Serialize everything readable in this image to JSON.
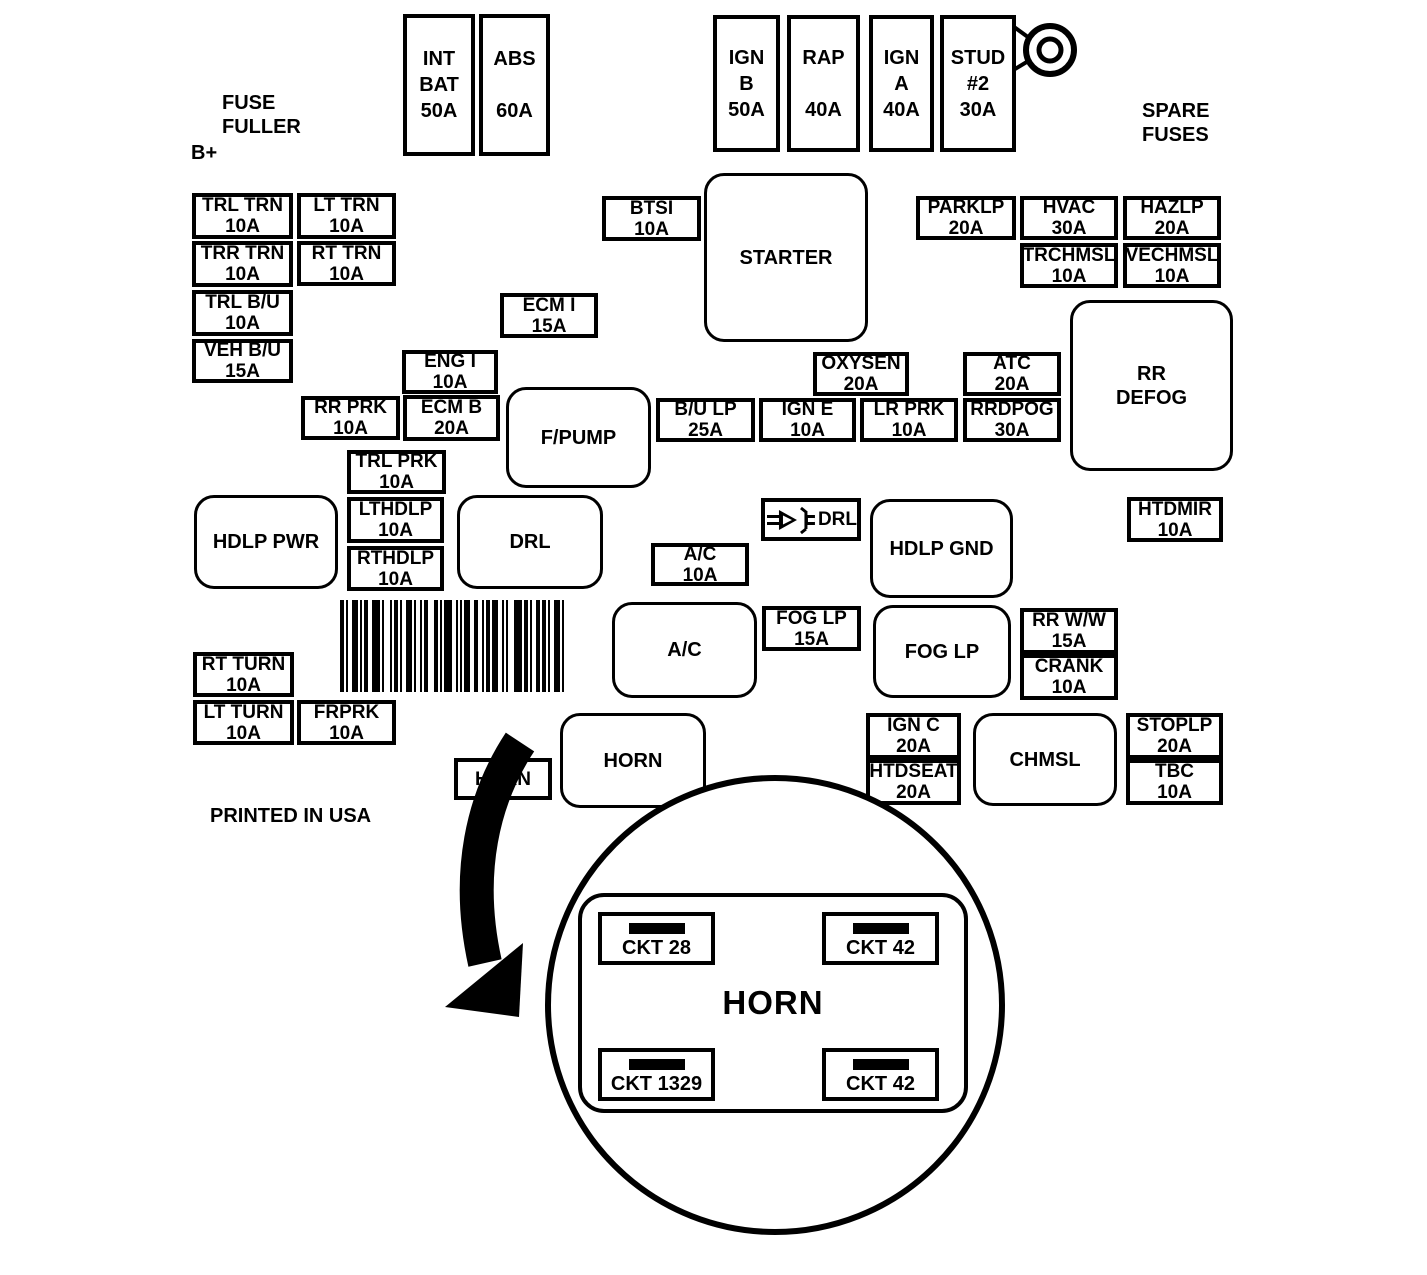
{
  "labels": [
    {
      "name": "fuse-puller-label",
      "lines": [
        "FUSE",
        "FULLER"
      ],
      "x": 222,
      "y": 91
    },
    {
      "name": "b-plus-label",
      "lines": [
        "B+"
      ],
      "x": 191,
      "y": 141
    },
    {
      "name": "spare-fuses-label",
      "lines": [
        "SPARE",
        "FUSES"
      ],
      "x": 1142,
      "y": 99
    },
    {
      "name": "printed-in-usa-label",
      "lines": [
        "PRINTED IN USA"
      ],
      "x": 210,
      "y": 804
    }
  ],
  "boxes": [
    {
      "name": "int-bat-fuse",
      "kind": "tall",
      "lines": [
        "INT",
        "BAT",
        "50A"
      ],
      "x": 403,
      "y": 14,
      "w": 72,
      "h": 142
    },
    {
      "name": "abs-fuse",
      "kind": "tall",
      "lines": [
        "ABS",
        "",
        "60A"
      ],
      "x": 479,
      "y": 14,
      "w": 71,
      "h": 142
    },
    {
      "name": "ign-b-fuse",
      "kind": "tall",
      "lines": [
        "IGN",
        "B",
        "50A"
      ],
      "x": 713,
      "y": 15,
      "w": 67,
      "h": 137
    },
    {
      "name": "rap-fuse",
      "kind": "tall",
      "lines": [
        "RAP",
        "",
        "40A"
      ],
      "x": 787,
      "y": 15,
      "w": 73,
      "h": 137
    },
    {
      "name": "ign-a-fuse",
      "kind": "tall",
      "lines": [
        "IGN",
        "A",
        "40A"
      ],
      "x": 869,
      "y": 15,
      "w": 65,
      "h": 137
    },
    {
      "name": "stud-2-fuse",
      "kind": "tall",
      "lines": [
        "STUD",
        "#2",
        "30A"
      ],
      "x": 940,
      "y": 15,
      "w": 76,
      "h": 137
    },
    {
      "name": "trl-trn-fuse",
      "kind": "fuse",
      "lines": [
        "TRL TRN",
        "10A"
      ],
      "x": 192,
      "y": 193,
      "w": 101,
      "h": 46
    },
    {
      "name": "lt-trn-fuse",
      "kind": "fuse",
      "lines": [
        "LT TRN",
        "10A"
      ],
      "x": 297,
      "y": 193,
      "w": 99,
      "h": 46
    },
    {
      "name": "trr-trn-fuse",
      "kind": "fuse",
      "lines": [
        "TRR TRN",
        "10A"
      ],
      "x": 192,
      "y": 241,
      "w": 101,
      "h": 46
    },
    {
      "name": "rt-trn-fuse",
      "kind": "fuse",
      "lines": [
        "RT TRN",
        "10A"
      ],
      "x": 297,
      "y": 241,
      "w": 99,
      "h": 45
    },
    {
      "name": "trl-bu-fuse",
      "kind": "fuse",
      "lines": [
        "TRL B/U",
        "10A"
      ],
      "x": 192,
      "y": 290,
      "w": 101,
      "h": 46
    },
    {
      "name": "veh-bu-fuse",
      "kind": "fuse",
      "lines": [
        "VEH B/U",
        "15A"
      ],
      "x": 192,
      "y": 339,
      "w": 101,
      "h": 44
    },
    {
      "name": "btsi-fuse",
      "kind": "fuse",
      "lines": [
        "BTSI",
        "10A"
      ],
      "x": 602,
      "y": 196,
      "w": 99,
      "h": 45
    },
    {
      "name": "starter-relay",
      "kind": "relay",
      "lines": [
        "STARTER"
      ],
      "x": 704,
      "y": 173,
      "w": 164,
      "h": 169
    },
    {
      "name": "parklp-fuse",
      "kind": "fuse",
      "lines": [
        "PARKLP",
        "20A"
      ],
      "x": 916,
      "y": 196,
      "w": 100,
      "h": 44
    },
    {
      "name": "hvac-fuse",
      "kind": "fuse",
      "lines": [
        "HVAC",
        "30A"
      ],
      "x": 1020,
      "y": 196,
      "w": 98,
      "h": 44
    },
    {
      "name": "hazlp-fuse",
      "kind": "fuse",
      "lines": [
        "HAZLP",
        "20A"
      ],
      "x": 1123,
      "y": 196,
      "w": 98,
      "h": 44
    },
    {
      "name": "trchmsl-fuse",
      "kind": "fuse",
      "lines": [
        "TRCHMSL",
        "10A"
      ],
      "x": 1020,
      "y": 243,
      "w": 98,
      "h": 45
    },
    {
      "name": "vechmsl-fuse",
      "kind": "fuse",
      "lines": [
        "VECHMSL",
        "10A"
      ],
      "x": 1123,
      "y": 243,
      "w": 98,
      "h": 45
    },
    {
      "name": "ecm-i-fuse",
      "kind": "fuse",
      "lines": [
        "ECM I",
        "15A"
      ],
      "x": 500,
      "y": 293,
      "w": 98,
      "h": 45
    },
    {
      "name": "rr-defog-relay",
      "kind": "relay",
      "lines": [
        "RR",
        "DEFOG"
      ],
      "x": 1070,
      "y": 300,
      "w": 163,
      "h": 171
    },
    {
      "name": "eng-i-fuse",
      "kind": "fuse",
      "lines": [
        "ENG I",
        "10A"
      ],
      "x": 402,
      "y": 350,
      "w": 96,
      "h": 44
    },
    {
      "name": "oxysen-fuse",
      "kind": "fuse",
      "lines": [
        "OXYSEN",
        "20A"
      ],
      "x": 813,
      "y": 352,
      "w": 96,
      "h": 44
    },
    {
      "name": "atc-fuse",
      "kind": "fuse",
      "lines": [
        "ATC",
        "20A"
      ],
      "x": 963,
      "y": 352,
      "w": 98,
      "h": 44
    },
    {
      "name": "rr-prk-fuse",
      "kind": "fuse",
      "lines": [
        "RR PRK",
        "10A"
      ],
      "x": 301,
      "y": 396,
      "w": 99,
      "h": 44
    },
    {
      "name": "ecm-b-fuse",
      "kind": "fuse",
      "lines": [
        "ECM B",
        "20A"
      ],
      "x": 403,
      "y": 395,
      "w": 97,
      "h": 46
    },
    {
      "name": "f-pump-relay",
      "kind": "relay",
      "lines": [
        "F/PUMP"
      ],
      "x": 506,
      "y": 387,
      "w": 145,
      "h": 101
    },
    {
      "name": "bu-lp-fuse",
      "kind": "fuse",
      "lines": [
        "B/U LP",
        "25A"
      ],
      "x": 656,
      "y": 398,
      "w": 99,
      "h": 44
    },
    {
      "name": "ign-e-fuse",
      "kind": "fuse",
      "lines": [
        "IGN E",
        "10A"
      ],
      "x": 759,
      "y": 398,
      "w": 97,
      "h": 44
    },
    {
      "name": "lr-prk-fuse",
      "kind": "fuse",
      "lines": [
        "LR PRK",
        "10A"
      ],
      "x": 860,
      "y": 398,
      "w": 98,
      "h": 44
    },
    {
      "name": "rrdpog-fuse",
      "kind": "fuse",
      "lines": [
        "RRDPOG",
        "30A"
      ],
      "x": 963,
      "y": 398,
      "w": 98,
      "h": 44
    },
    {
      "name": "trl-prk-fuse",
      "kind": "fuse",
      "lines": [
        "TRL PRK",
        "10A"
      ],
      "x": 347,
      "y": 450,
      "w": 99,
      "h": 44
    },
    {
      "name": "hdlp-pwr-relay",
      "kind": "relay",
      "lines": [
        "HDLP PWR"
      ],
      "x": 194,
      "y": 495,
      "w": 144,
      "h": 94
    },
    {
      "name": "lthdlp-fuse",
      "kind": "fuse",
      "lines": [
        "LTHDLP",
        "10A"
      ],
      "x": 347,
      "y": 497,
      "w": 97,
      "h": 46
    },
    {
      "name": "rthdlp-fuse",
      "kind": "fuse",
      "lines": [
        "RTHDLP",
        "10A"
      ],
      "x": 347,
      "y": 546,
      "w": 97,
      "h": 45
    },
    {
      "name": "drl-relay",
      "kind": "relay",
      "lines": [
        "DRL"
      ],
      "x": 457,
      "y": 495,
      "w": 146,
      "h": 94
    },
    {
      "name": "hdlp-gnd-relay",
      "kind": "relay",
      "lines": [
        "HDLP GND"
      ],
      "x": 870,
      "y": 499,
      "w": 143,
      "h": 99
    },
    {
      "name": "htdmir-fuse",
      "kind": "fuse",
      "lines": [
        "HTDMIR",
        "10A"
      ],
      "x": 1127,
      "y": 497,
      "w": 96,
      "h": 45
    },
    {
      "name": "ac-fuse",
      "kind": "fuse",
      "lines": [
        "A/C",
        "10A"
      ],
      "x": 651,
      "y": 543,
      "w": 98,
      "h": 43
    },
    {
      "name": "ac-relay",
      "kind": "relay",
      "lines": [
        "A/C"
      ],
      "x": 612,
      "y": 602,
      "w": 145,
      "h": 96
    },
    {
      "name": "fog-lp-fuse",
      "kind": "fuse",
      "lines": [
        "FOG LP",
        "15A"
      ],
      "x": 762,
      "y": 606,
      "w": 99,
      "h": 45
    },
    {
      "name": "fog-lp-relay",
      "kind": "relay",
      "lines": [
        "FOG LP"
      ],
      "x": 873,
      "y": 605,
      "w": 138,
      "h": 93
    },
    {
      "name": "rr-ww-fuse",
      "kind": "fuse",
      "lines": [
        "RR W/W",
        "15A"
      ],
      "x": 1020,
      "y": 608,
      "w": 98,
      "h": 46
    },
    {
      "name": "crank-fuse",
      "kind": "fuse",
      "lines": [
        "CRANK",
        "10A"
      ],
      "x": 1020,
      "y": 654,
      "w": 98,
      "h": 46
    },
    {
      "name": "rt-turn-fuse",
      "kind": "fuse",
      "lines": [
        "RT TURN",
        "10A"
      ],
      "x": 193,
      "y": 652,
      "w": 101,
      "h": 45
    },
    {
      "name": "lt-turn-fuse",
      "kind": "fuse",
      "lines": [
        "LT TURN",
        "10A"
      ],
      "x": 193,
      "y": 700,
      "w": 101,
      "h": 45
    },
    {
      "name": "frprk-fuse",
      "kind": "fuse",
      "lines": [
        "FRPRK",
        "10A"
      ],
      "x": 297,
      "y": 700,
      "w": 99,
      "h": 45
    },
    {
      "name": "horn-fuse",
      "kind": "fuse",
      "lines": [
        "HORN"
      ],
      "x": 454,
      "y": 758,
      "w": 98,
      "h": 42
    },
    {
      "name": "horn-relay",
      "kind": "relay",
      "lines": [
        "HORN"
      ],
      "x": 560,
      "y": 713,
      "w": 146,
      "h": 95
    },
    {
      "name": "ign-c-fuse",
      "kind": "fuse",
      "lines": [
        "IGN C",
        "20A"
      ],
      "x": 866,
      "y": 713,
      "w": 95,
      "h": 46
    },
    {
      "name": "htdseat-fuse",
      "kind": "fuse",
      "lines": [
        "HTDSEAT",
        "20A"
      ],
      "x": 866,
      "y": 759,
      "w": 95,
      "h": 46
    },
    {
      "name": "chmsl-relay",
      "kind": "relay",
      "lines": [
        "CHMSL"
      ],
      "x": 973,
      "y": 713,
      "w": 144,
      "h": 93
    },
    {
      "name": "stoplp-fuse",
      "kind": "fuse",
      "lines": [
        "STOPLP",
        "20A"
      ],
      "x": 1126,
      "y": 713,
      "w": 97,
      "h": 46
    },
    {
      "name": "tbc-fuse",
      "kind": "fuse",
      "lines": [
        "TBC",
        "10A"
      ],
      "x": 1126,
      "y": 759,
      "w": 97,
      "h": 46
    }
  ],
  "diode": {
    "label": "DRL"
  },
  "magnifier": {
    "title": "HORN",
    "terminals": [
      {
        "label": "CKT 28",
        "x": 598,
        "y": 912
      },
      {
        "label": "CKT 42",
        "x": 822,
        "y": 912
      },
      {
        "label": "CKT 1329",
        "x": 598,
        "y": 1048
      },
      {
        "label": "CKT 42",
        "x": 822,
        "y": 1048
      }
    ]
  }
}
